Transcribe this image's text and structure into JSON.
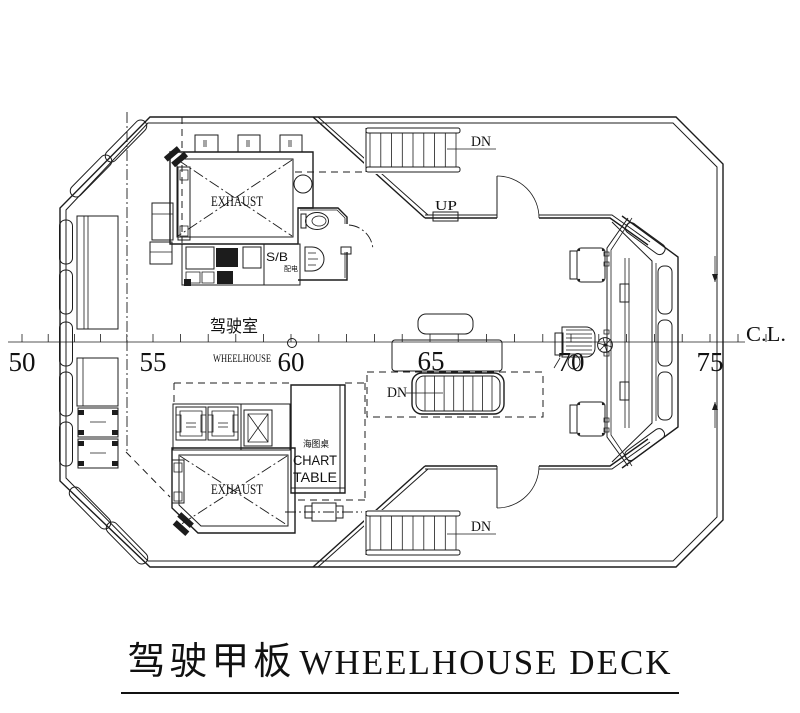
{
  "drawing": {
    "title_cn": "驾驶甲板",
    "title_en": "WHEELHOUSE DECK",
    "room_label_cn": "驾驶室",
    "room_label_en": "WHEELHOUSE",
    "centerline_label": "C.L.",
    "exhaust_top": "EXHAUST",
    "exhaust_bottom": "EXHAUST",
    "sb_label": "S/B",
    "sb_sublabel_cn": "配电",
    "chart_table_cn": "海图桌",
    "chart_table_en_1": "CHART",
    "chart_table_en_2": "TABLE",
    "stairs_top_label": "DN",
    "stairs_mid_label": "DN",
    "stairs_bottom_label": "DN",
    "up_label": "UP",
    "frames": [
      "50",
      "55",
      "60",
      "65",
      "70",
      "75"
    ]
  }
}
